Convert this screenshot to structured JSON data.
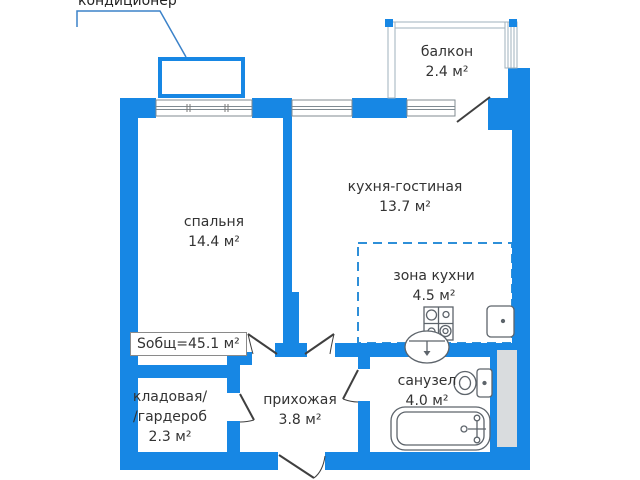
{
  "plan": {
    "callout": {
      "label": "кондиционер"
    },
    "total_area": {
      "label": "Sобщ=45.1 м²"
    },
    "rooms": {
      "balcony": {
        "name": "балкон",
        "area": "2.4 м²"
      },
      "bedroom": {
        "name": "спальня",
        "area": "14.4 м²"
      },
      "kitchen_living": {
        "name": "кухня-гостиная",
        "area": "13.7 м²"
      },
      "kitchen_zone": {
        "name": "зона кухни",
        "area": "4.5 м²"
      },
      "storage": {
        "line1": "кладовая/",
        "line2": "/гардероб",
        "area": "2.3 м²"
      },
      "hallway": {
        "name": "прихожая",
        "area": "3.8 м²"
      },
      "bathroom": {
        "name": "санузел",
        "area": "4.0 м²"
      }
    },
    "colors": {
      "wall": "#1787e4",
      "balcony_frame": "#9fb0bc",
      "window_frame": "#808b92",
      "door": "#3f3f3f",
      "kitchen_zone_dash": "#2e8fd8",
      "leader_line": "#3b82c9",
      "shaft_fill": "#d9dcde",
      "text": "#333333"
    }
  }
}
